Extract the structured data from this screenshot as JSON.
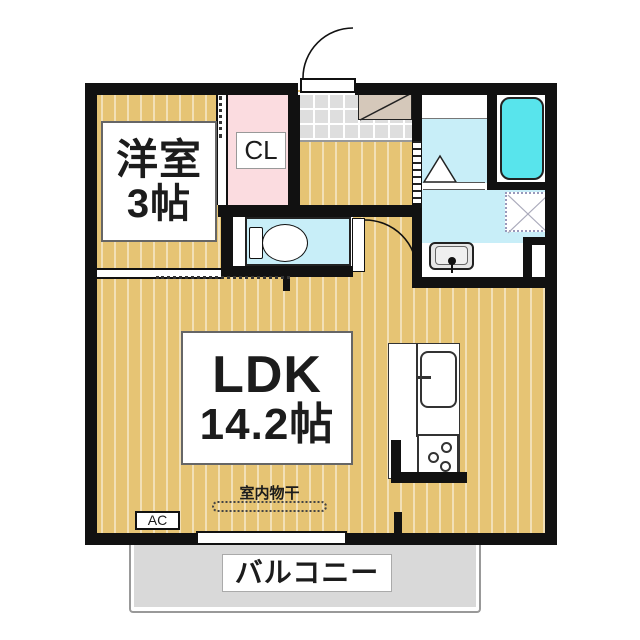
{
  "plan": {
    "rooms": {
      "western_room": {
        "name": "洋室",
        "size": "3帖"
      },
      "closet": {
        "label": "CL"
      },
      "ldk": {
        "name": "LDK",
        "size": "14.2帖"
      },
      "balcony": {
        "label": "バルコニー"
      },
      "indoor_drying": {
        "label": "室内物干"
      },
      "air_conditioner": {
        "label": "AC"
      }
    },
    "icons": {
      "toilet": "toilet-icon",
      "bathtub": "bathtub-icon",
      "shower_slope": "shower-triangle-icon",
      "washing_machine_pan": "washing-machine-pan-icon",
      "washbasin": "washbasin-icon",
      "kitchen_sink": "kitchen-sink-icon",
      "gas_stove": "gas-stove-icon",
      "shoe_cabinet": "shoe-cabinet-icon",
      "entrance_door": "door-swing-icon",
      "toilet_door": "door-swing-icon",
      "ldk_window": "sliding-window-icon"
    },
    "colors": {
      "wood": "#e6c474",
      "closet-pink": "#fbdce0",
      "water-cyan": "#c8eef8",
      "bathtub-cyan": "#58e4ec",
      "tile-gray": "#dedede",
      "cabinet-tan": "#d5c8ba",
      "balcony-gray": "#d9d9d9",
      "wall": "#111111",
      "text": "#1c1c1c"
    }
  }
}
